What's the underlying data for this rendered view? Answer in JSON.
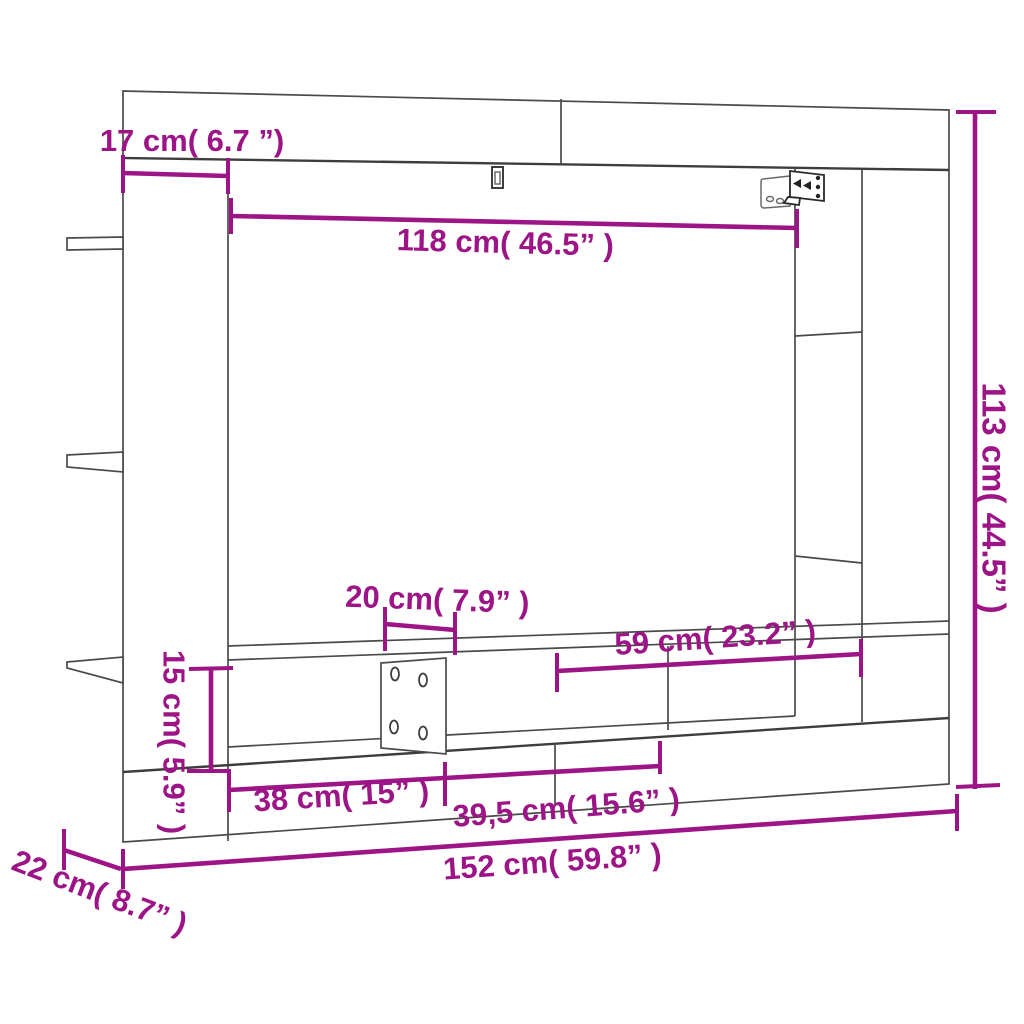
{
  "diagram": {
    "type": "furniture-dimension-diagram",
    "product": "wall-mounted TV cabinet",
    "unit_style": "cm (inches)",
    "labels": {
      "top_side_width": "17 cm( 6.7 ”)",
      "opening_width": "118 cm( 46.5” )",
      "total_height": "113 cm( 44.5” )",
      "shelf_spacing": "20 cm( 7.9” )",
      "right_shelf_width": "59 cm( 23.2” )",
      "shelf_opening_height": "15 cm( 5.9” )",
      "bottom_left_compartment_width": "38 cm( 15” )",
      "bottom_middle_compartment_width": "39,5 cm( 15.6” )",
      "total_width": "152 cm( 59.8” )",
      "depth": "22 cm( 8.7” )"
    },
    "colors": {
      "dimension": "#9d1486",
      "outline": "#4a4a4a",
      "background": "#ffffff"
    }
  }
}
